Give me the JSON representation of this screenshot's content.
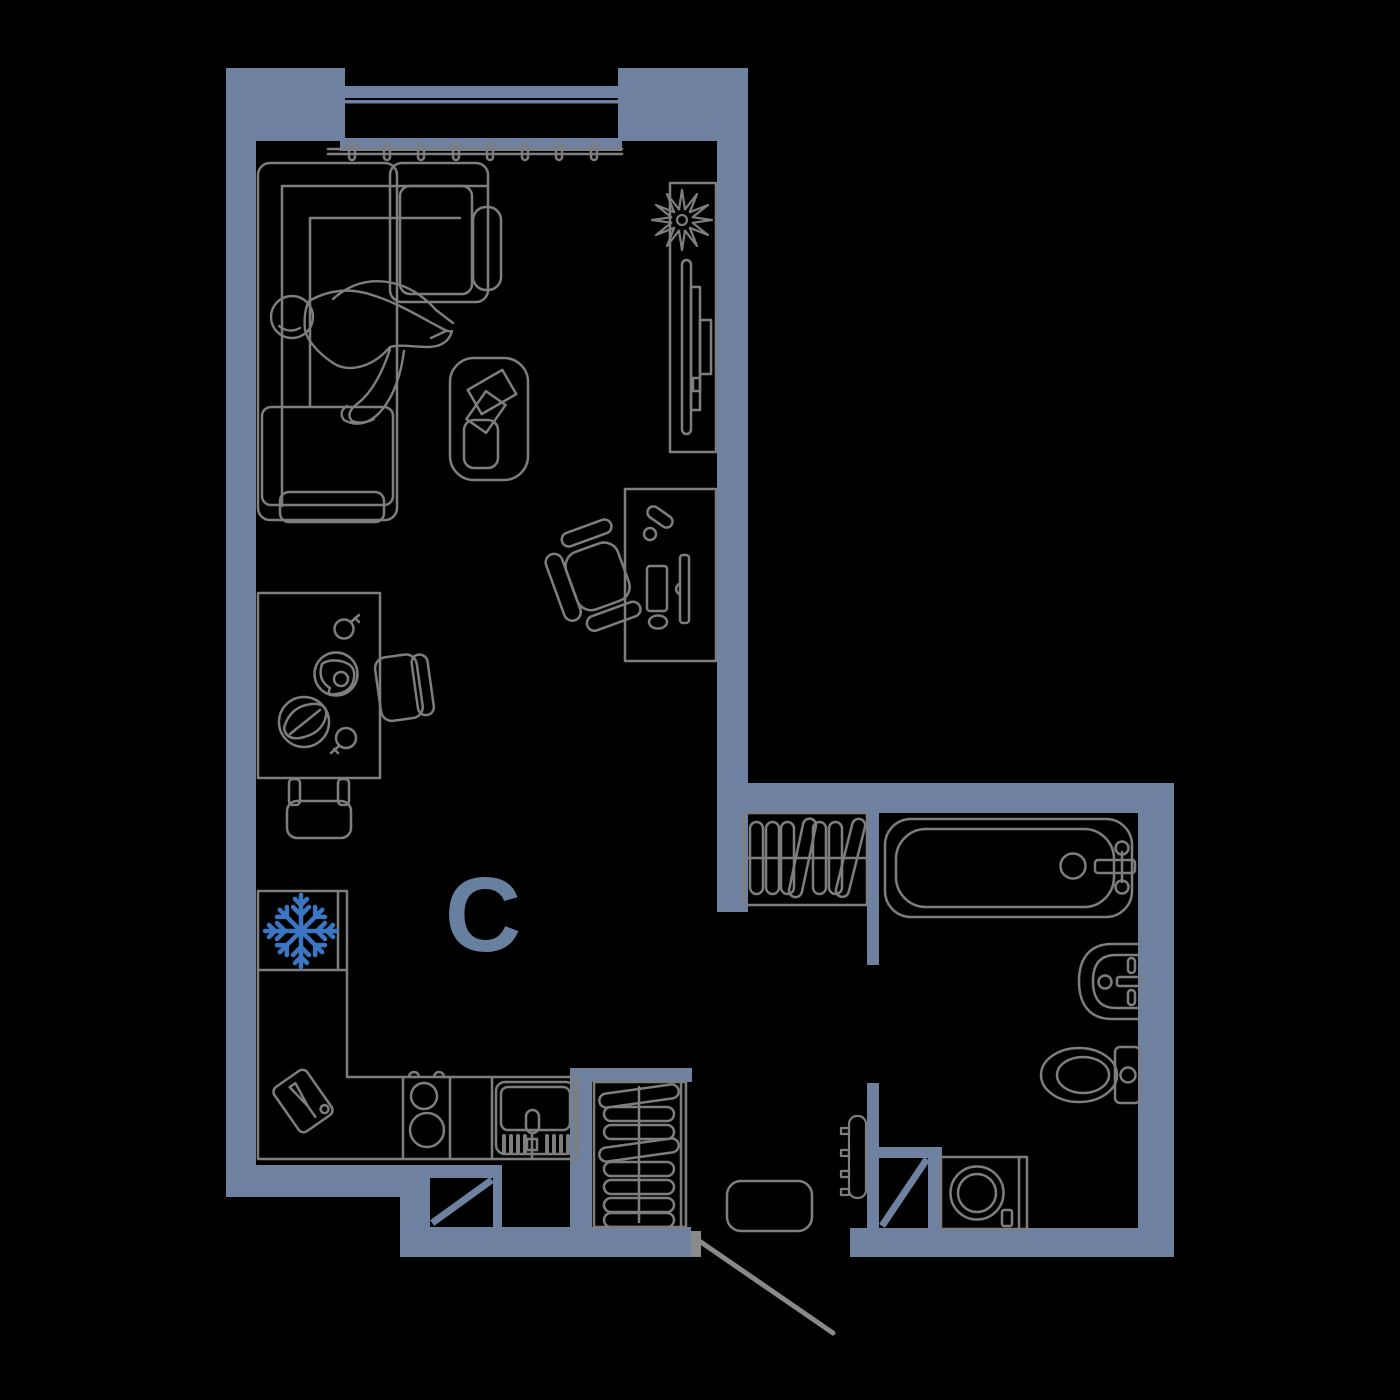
{
  "plan": {
    "label": "С",
    "colors": {
      "background": "#000000",
      "wall": "#6e81a0",
      "furniture_line": "#7e7e7e",
      "door_line": "#8a8a8a",
      "accent_snowflake": "#3b76c4",
      "label": "#68809f"
    },
    "icons": [
      {
        "name": "snowflake-icon",
        "represents": "refrigerator"
      }
    ],
    "floorplan_objects": [
      "window",
      "curtain-rod",
      "corner-sofa",
      "person-on-sofa",
      "coffee-table",
      "plant",
      "tv-console",
      "tv",
      "desk",
      "office-chair",
      "dining-table",
      "dining-chairs",
      "refrigerator",
      "kitchen-counter",
      "stove",
      "kitchen-sink",
      "cutting-board",
      "wardrobe",
      "hall-closet",
      "doormat",
      "entrance-door",
      "ventilation-shafts",
      "bathtub",
      "washbasin",
      "toilet",
      "towel-rail",
      "washing-machine"
    ]
  }
}
